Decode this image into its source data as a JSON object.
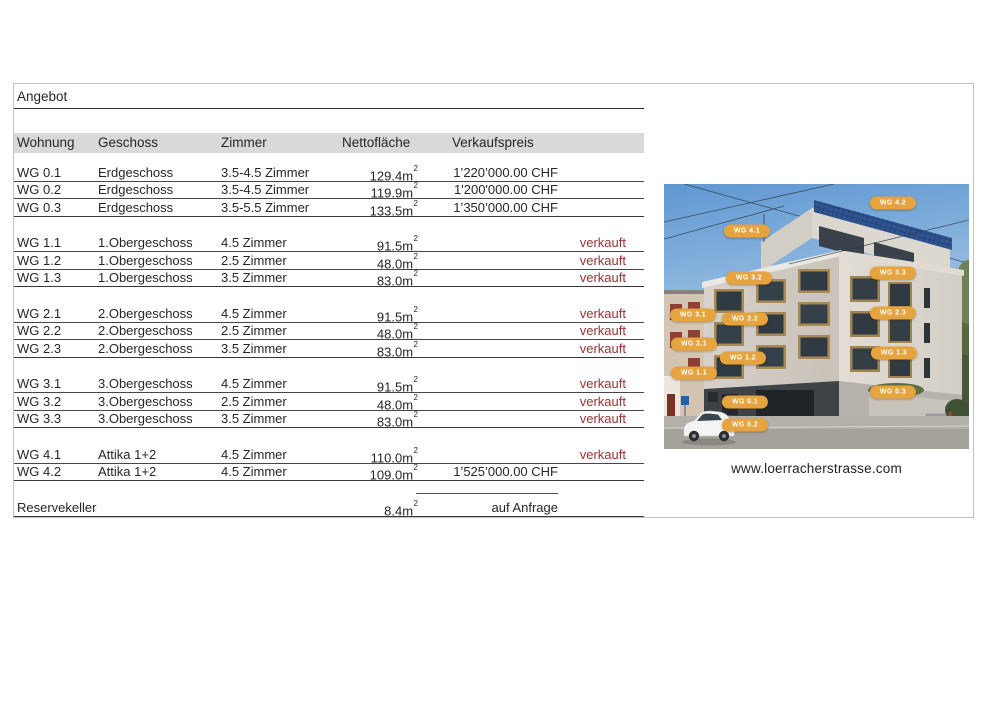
{
  "title": "Angebot",
  "table": {
    "headers": [
      "Wohnung",
      "Geschoss",
      "Zimmer",
      "Nettofläche",
      "Verkaufspreis"
    ],
    "area_sup": "2",
    "sections": [
      {
        "rows": [
          {
            "unit": "WG 0.1",
            "floor": "Erdgeschoss",
            "rooms": "3.5-4.5 Zimmer",
            "area": "129.4m",
            "price": "1’220’000.00 CHF",
            "status": ""
          },
          {
            "unit": "WG 0.2",
            "floor": "Erdgeschoss",
            "rooms": "3.5-4.5 Zimmer",
            "area": "119.9m",
            "price": "1'200'000.00 CHF",
            "status": ""
          },
          {
            "unit": "WG 0.3",
            "floor": "Erdgeschoss",
            "rooms": "3.5-5.5 Zimmer",
            "area": "133.5m",
            "price": "1’350’000.00 CHF",
            "status": ""
          }
        ]
      },
      {
        "rows": [
          {
            "unit": "WG 1.1",
            "floor": "1.Obergeschoss",
            "rooms": "4.5 Zimmer",
            "area": "91.5m",
            "price": "",
            "status": "verkauft"
          },
          {
            "unit": "WG 1.2",
            "floor": "1.Obergeschoss",
            "rooms": "2.5 Zimmer",
            "area": "48.0m",
            "price": "",
            "status": "verkauft"
          },
          {
            "unit": "WG 1.3",
            "floor": "1.Obergeschoss",
            "rooms": "3.5 Zimmer",
            "area": "83.0m",
            "price": "",
            "status": "verkauft"
          }
        ]
      },
      {
        "rows": [
          {
            "unit": "WG 2.1",
            "floor": "2.Obergeschoss",
            "rooms": "4.5 Zimmer",
            "area": "91.5m",
            "price": "",
            "status": "verkauft"
          },
          {
            "unit": "WG 2.2",
            "floor": "2.Obergeschoss",
            "rooms": "2.5 Zimmer",
            "area": "48.0m",
            "price": "",
            "status": "verkauft"
          },
          {
            "unit": "WG 2.3",
            "floor": "2.Obergeschoss",
            "rooms": "3.5 Zimmer",
            "area": "83.0m",
            "price": "",
            "status": "verkauft"
          }
        ]
      },
      {
        "rows": [
          {
            "unit": "WG 3.1",
            "floor": "3.Obergeschoss",
            "rooms": "4.5 Zimmer",
            "area": "91.5m",
            "price": "",
            "status": "verkauft"
          },
          {
            "unit": "WG 3.2",
            "floor": "3.Obergeschoss",
            "rooms": "2.5 Zimmer",
            "area": "48.0m",
            "price": "",
            "status": "verkauft"
          },
          {
            "unit": "WG 3.3",
            "floor": "3.Obergeschoss",
            "rooms": "3.5 Zimmer",
            "area": "83.0m",
            "price": "",
            "status": "verkauft"
          }
        ]
      },
      {
        "rows": [
          {
            "unit": "WG 4.1",
            "floor": "Attika 1+2",
            "rooms": "4.5 Zimmer",
            "area": "110.0m",
            "price": "",
            "status": "verkauft"
          },
          {
            "unit": "WG 4.2",
            "floor": "Attika 1+2",
            "rooms": "4.5 Zimmer",
            "area": "109.0m",
            "price": "1’525’000.00 CHF",
            "status": ""
          }
        ]
      },
      {
        "rows": [
          {
            "unit": "Reservekeller",
            "floor": "",
            "rooms": "",
            "area": "8.4m",
            "price": "auf Anfrage",
            "status": ""
          }
        ]
      }
    ]
  },
  "photo": {
    "caption": "www.loerracherstrasse.com",
    "labels": [
      {
        "text": "WG 4.2",
        "x": 229,
        "y": 19
      },
      {
        "text": "WG 4.1",
        "x": 83,
        "y": 47
      },
      {
        "text": "WG 3.2",
        "x": 85,
        "y": 94
      },
      {
        "text": "WG 3.3",
        "x": 229,
        "y": 89
      },
      {
        "text": "WG 3.1",
        "x": 29,
        "y": 131
      },
      {
        "text": "WG 2.2",
        "x": 81,
        "y": 135
      },
      {
        "text": "WG 2.3",
        "x": 229,
        "y": 129
      },
      {
        "text": "WG 2.1",
        "x": 30,
        "y": 160
      },
      {
        "text": "WG 1.2",
        "x": 79,
        "y": 174
      },
      {
        "text": "WG 1.3",
        "x": 230,
        "y": 169
      },
      {
        "text": "WG 1.1",
        "x": 30,
        "y": 189
      },
      {
        "text": "WG 0.1",
        "x": 81,
        "y": 218
      },
      {
        "text": "WG 0.3",
        "x": 229,
        "y": 208
      },
      {
        "text": "WG 0.2",
        "x": 81,
        "y": 241
      }
    ]
  },
  "colors": {
    "sold_red": "#9e3132",
    "header_bg": "#d9d9d9",
    "label_orange": "#e7a33d",
    "table_line": "#474747",
    "frame_border": "#c2c2c2"
  }
}
